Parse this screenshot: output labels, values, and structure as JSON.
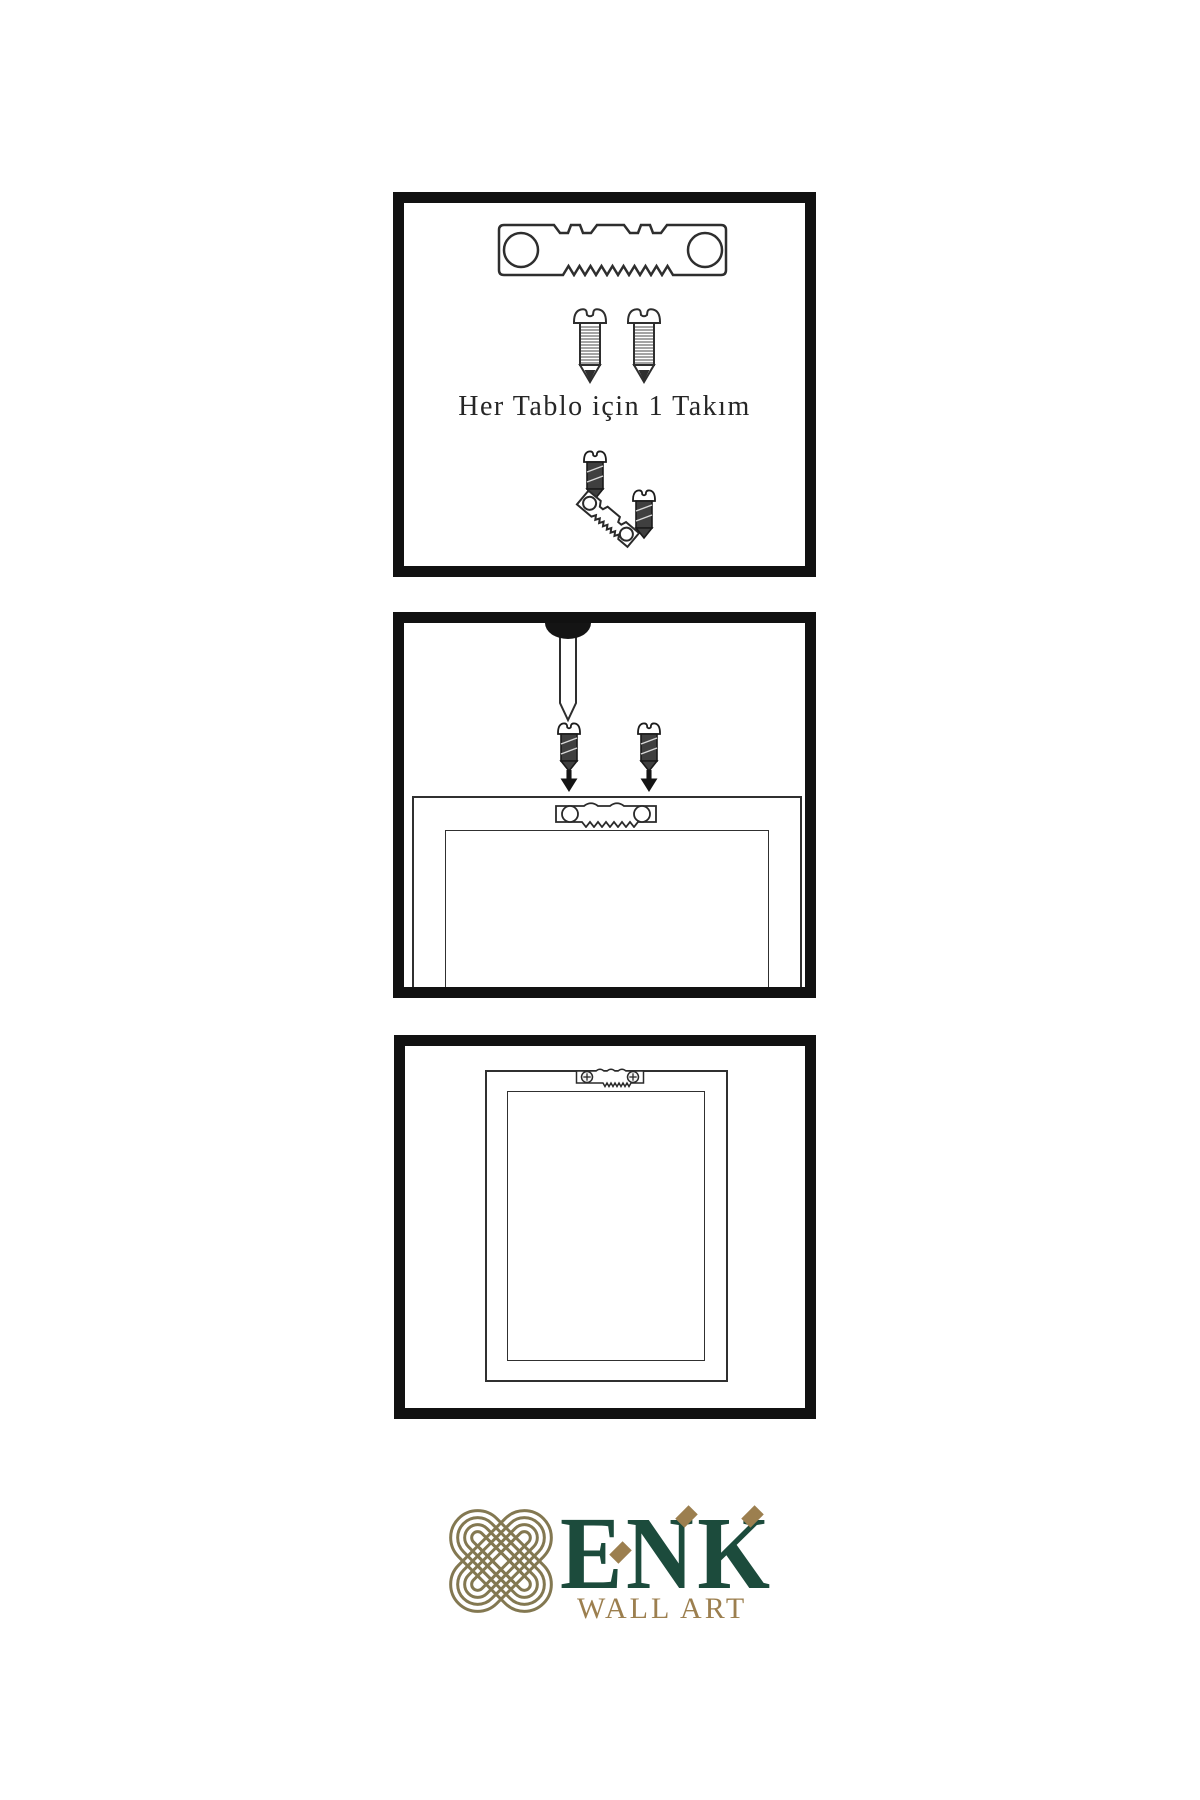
{
  "page": {
    "background": "#ffffff"
  },
  "colors": {
    "ink": "#2e2e2e",
    "panel_border": "#111111",
    "screw_dark_fill": "#3f3f3f",
    "brand_green": "#1c4b3c",
    "brand_gold": "#9c7f4f",
    "knot_olive": "#837851"
  },
  "panels": {
    "kit": {
      "caption": "Her Tablo için 1 Takım",
      "icons": [
        "sawtooth-hanger-icon",
        "screw-icon",
        "screw-icon",
        "screw-dark-icon",
        "tilted-sawtooth-hanger-icon",
        "screw-dark-icon"
      ]
    },
    "install": {
      "icons": [
        "wall-nail-icon",
        "screw-dark-icon",
        "screw-dark-icon",
        "down-arrow-icon",
        "down-arrow-icon",
        "sawtooth-hanger-icon",
        "frame-back-outline",
        "frame-back-inner-outline"
      ]
    },
    "result": {
      "icons": [
        "frame-back-outline",
        "frame-back-inner-outline",
        "mounted-sawtooth-hanger-icon"
      ]
    }
  },
  "logo": {
    "icon": "knot-icon",
    "brand": "ENK",
    "subtitle": "WALL ART"
  }
}
